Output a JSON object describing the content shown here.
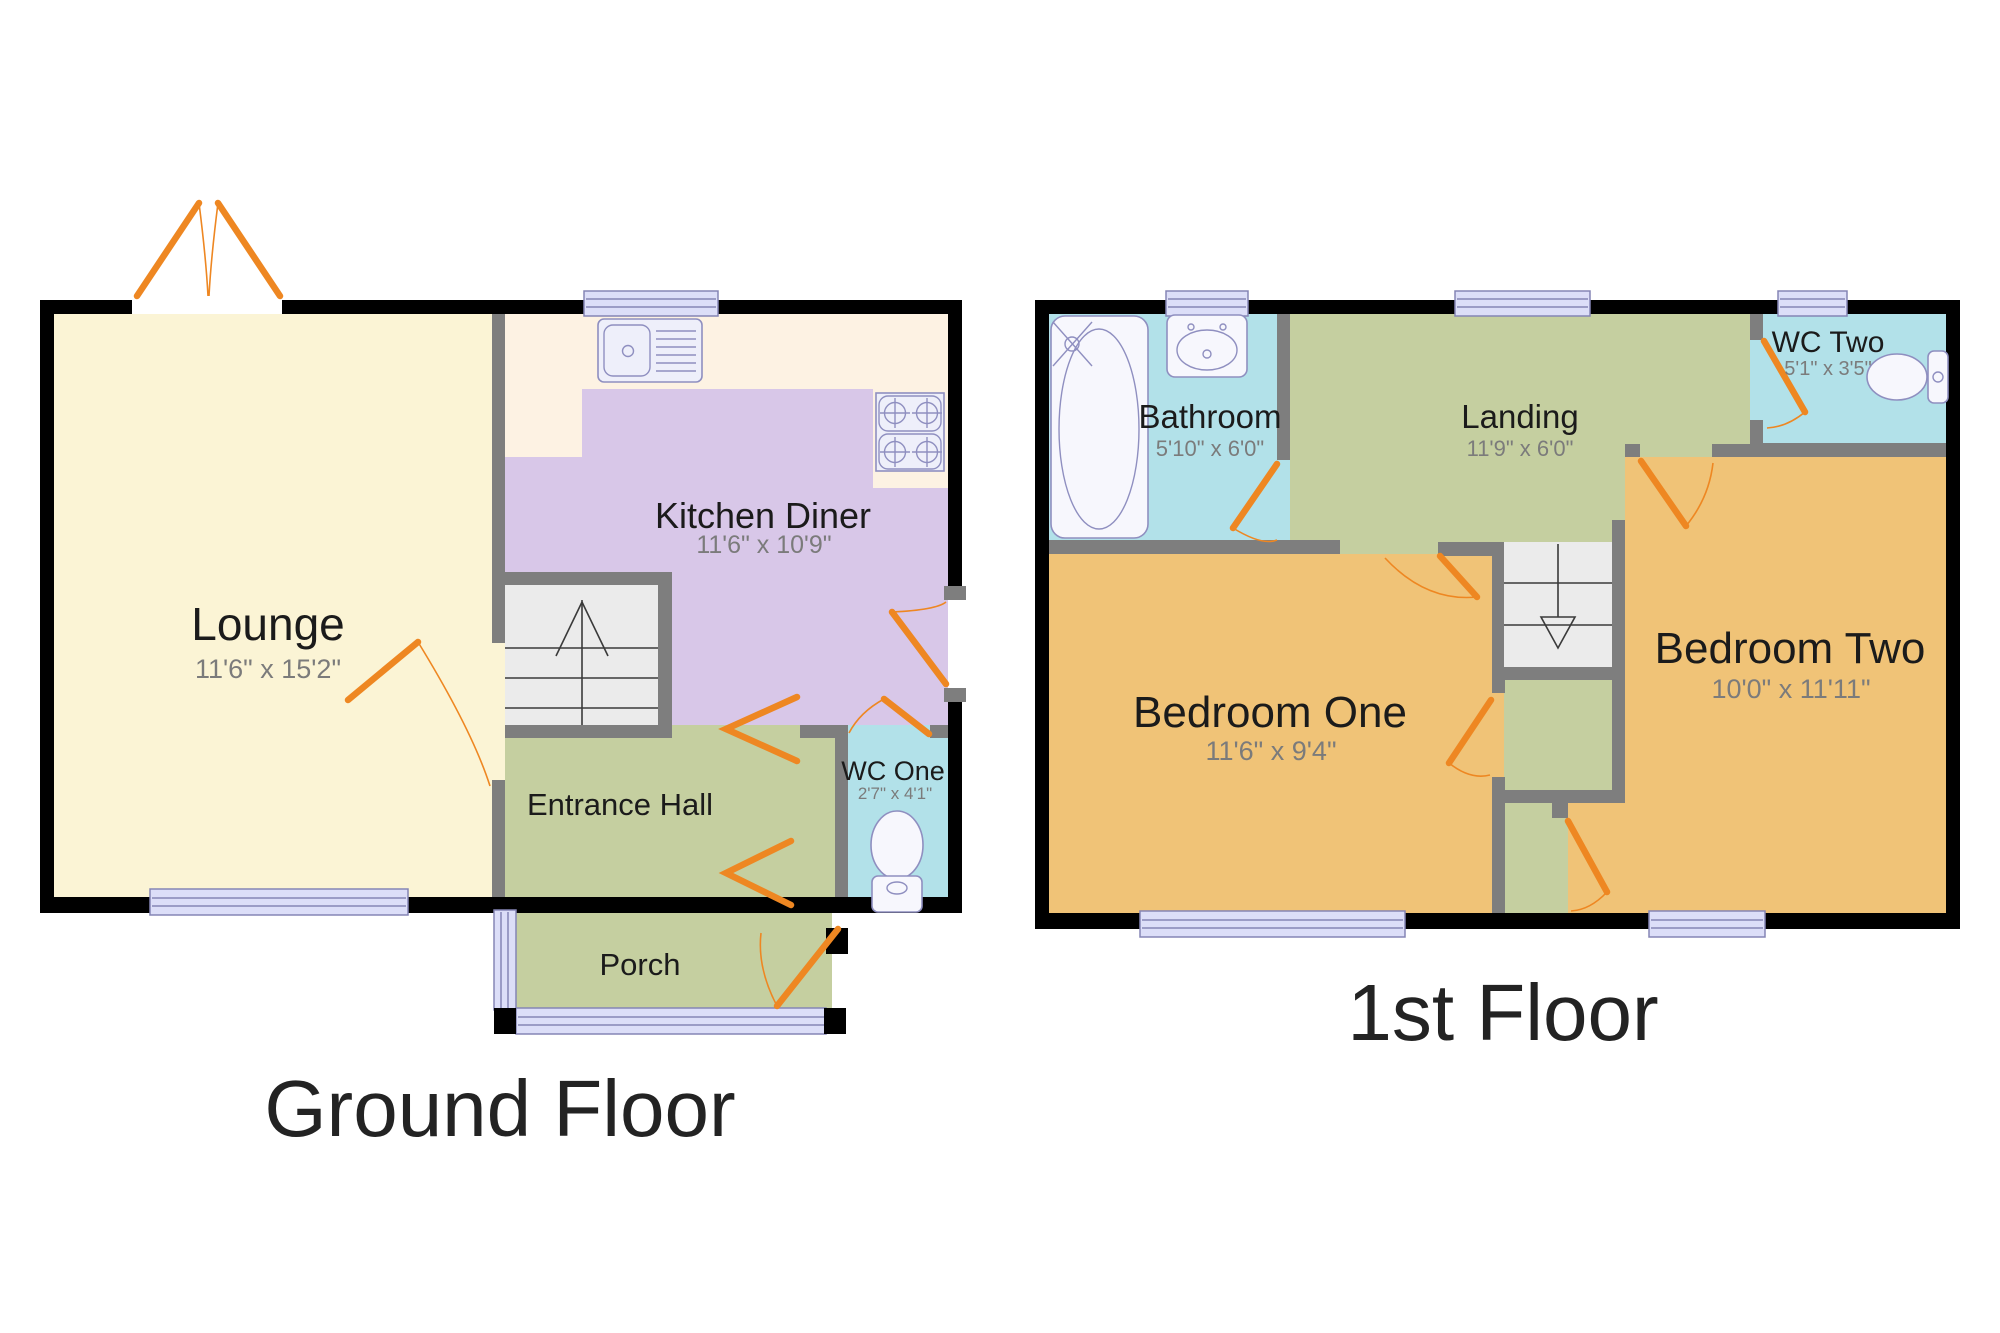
{
  "floors": [
    {
      "id": "ground-floor",
      "title": "Ground Floor",
      "rooms": [
        {
          "id": "lounge",
          "label": "Lounge",
          "dims": "11'6\" x 15'2\""
        },
        {
          "id": "kitchen-diner",
          "label": "Kitchen Diner",
          "dims": "11'6\" x 10'9\""
        },
        {
          "id": "entrance-hall",
          "label": "Entrance Hall",
          "dims": ""
        },
        {
          "id": "wc-one",
          "label": "WC One",
          "dims": "2'7\" x 4'1\""
        },
        {
          "id": "porch",
          "label": "Porch",
          "dims": ""
        }
      ]
    },
    {
      "id": "first-floor",
      "title": "1st Floor",
      "rooms": [
        {
          "id": "bathroom",
          "label": "Bathroom",
          "dims": "5'10\" x 6'0\""
        },
        {
          "id": "landing",
          "label": "Landing",
          "dims": "11'9\" x 6'0\""
        },
        {
          "id": "wc-two",
          "label": "WC Two",
          "dims": "5'1\" x 3'5\""
        },
        {
          "id": "bedroom-one",
          "label": "Bedroom One",
          "dims": "11'6\" x 9'4\""
        },
        {
          "id": "bedroom-two",
          "label": "Bedroom Two",
          "dims": "10'0\" x 11'11\""
        }
      ]
    }
  ],
  "colors": {
    "background": "#ffffff",
    "wall": "#000000",
    "wall_internal": "#7e7e7e",
    "lounge": "#fbf4d5",
    "kitchen_counter": "#fdf2e3",
    "kitchen": "#d8c7e8",
    "hall": "#c5cfa0",
    "wc": "#b2e1e9",
    "bedroom": "#f0c377",
    "stairs": "#ebebeb",
    "window": "#dcdef8",
    "door": "#ee8722",
    "fixture": "#eeeffa",
    "porcelain": "#f7f7fd"
  }
}
